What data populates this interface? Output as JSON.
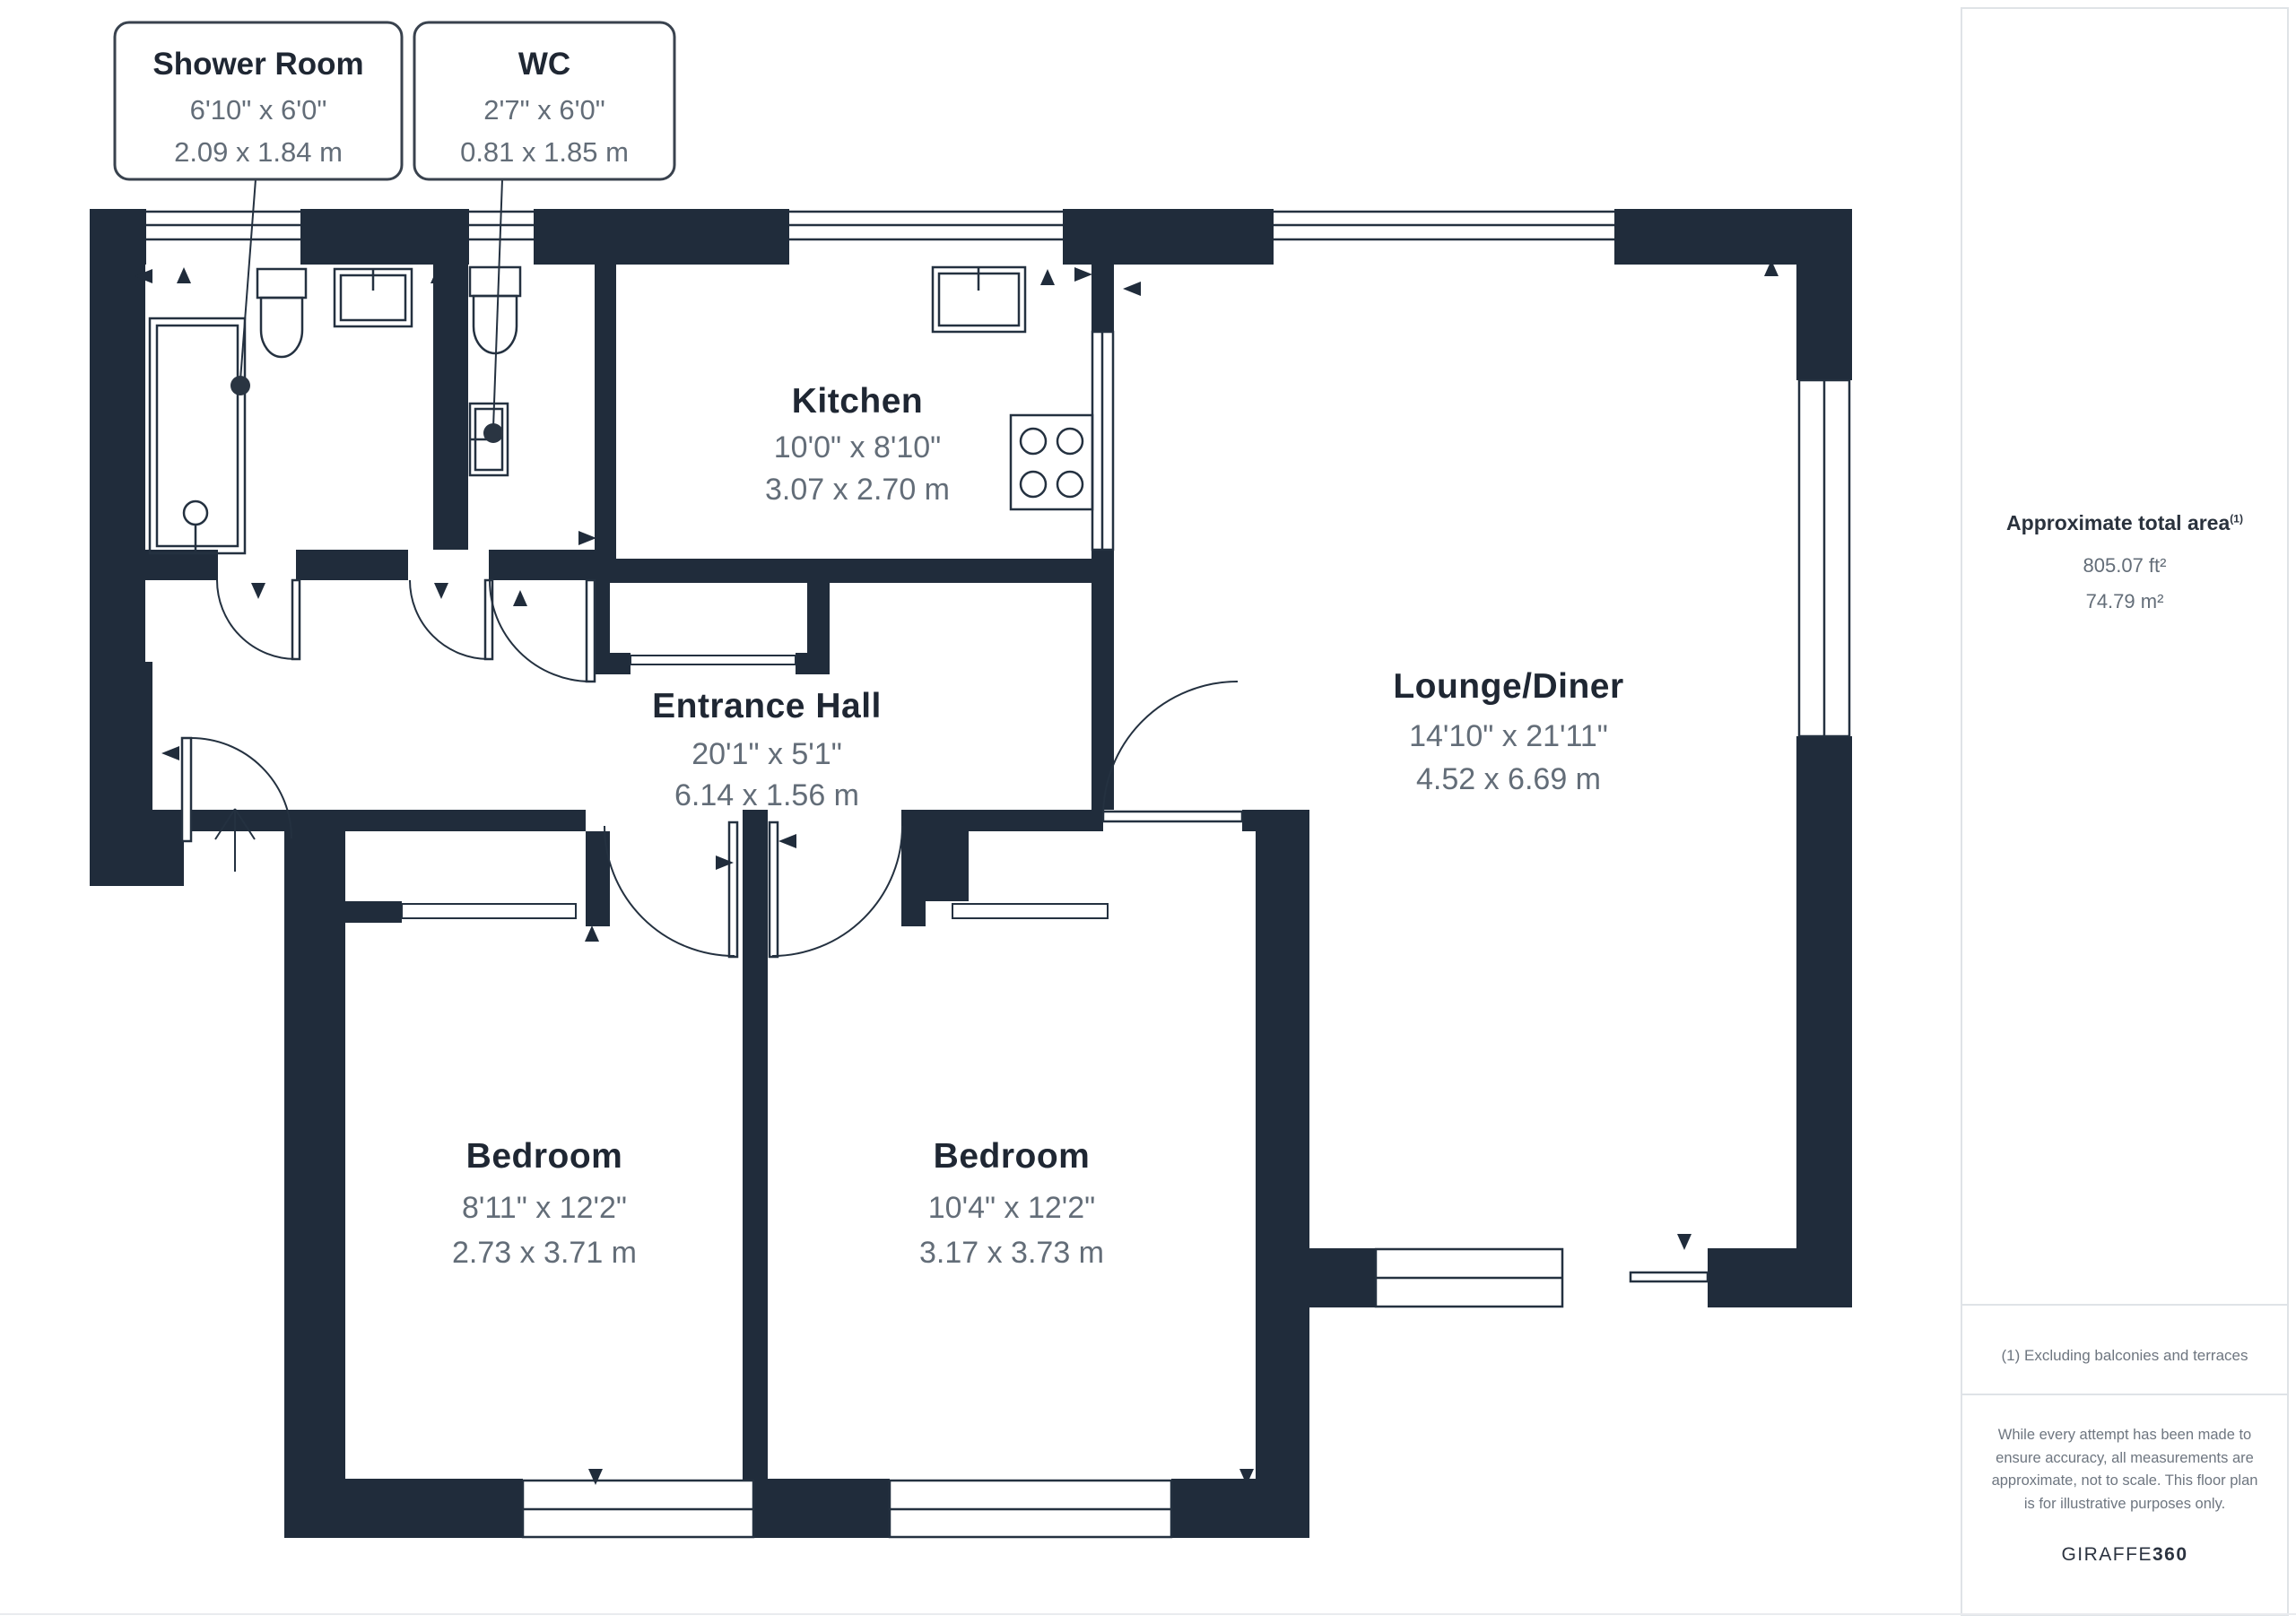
{
  "plan": {
    "callouts": [
      {
        "name": "Shower Room",
        "imperial": "6'10\" x 6'0\"",
        "metric": "2.09 x 1.84 m"
      },
      {
        "name": "WC",
        "imperial": "2'7\" x 6'0\"",
        "metric": "0.81 x 1.85 m"
      }
    ],
    "rooms": [
      {
        "name": "Kitchen",
        "imperial": "10'0\" x 8'10\"",
        "metric": "3.07 x 2.70 m"
      },
      {
        "name": "Entrance Hall",
        "imperial": "20'1\" x 5'1\"",
        "metric": "6.14 x 1.56 m"
      },
      {
        "name": "Lounge/Diner",
        "imperial": "14'10\" x 21'11\"",
        "metric": "4.52 x 6.69 m"
      },
      {
        "name": "Bedroom",
        "imperial": "8'11\" x 12'2\"",
        "metric": "2.73 x 3.71 m"
      },
      {
        "name": "Bedroom",
        "imperial": "10'4\" x 12'2\"",
        "metric": "3.17 x 3.73 m"
      }
    ]
  },
  "sidebar": {
    "title": "Approximate total area",
    "title_superscript": "(1)",
    "area_ft": "805.07 ft²",
    "area_m": "74.79 m²",
    "footnote": "(1) Excluding balconies and terraces",
    "disclaimer": "While every attempt has been made to ensure accuracy, all measurements are approximate, not to scale. This floor plan is for illustrative purposes only.",
    "brand_name": "GIRAFFE",
    "brand_suffix": "360"
  },
  "colors": {
    "wall": "#202C3B",
    "ink": "#1F2733",
    "dim": "#636D78",
    "line": "#243140",
    "panel-border": "#DFE3E7"
  }
}
